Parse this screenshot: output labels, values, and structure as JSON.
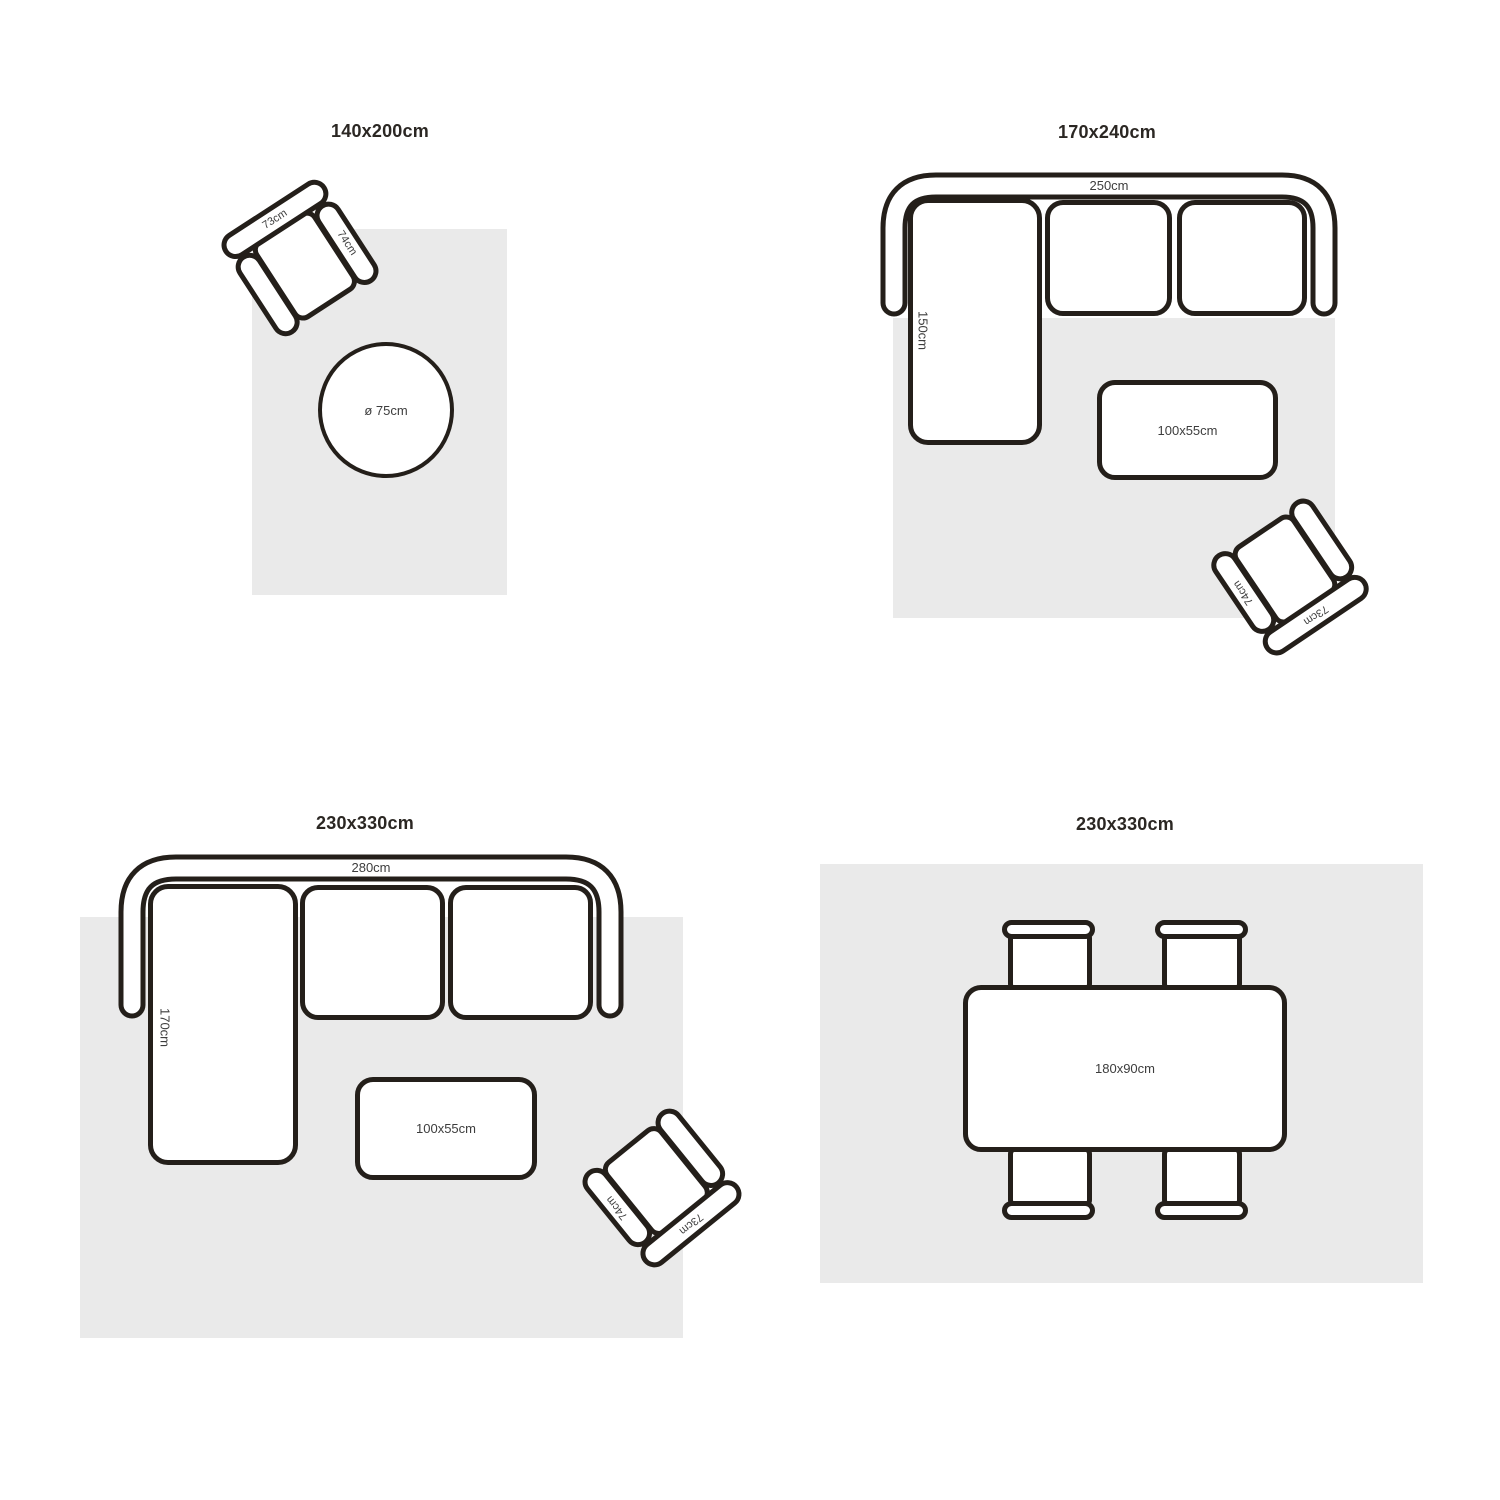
{
  "colors": {
    "background": "#ffffff",
    "rug": "#eaeaea",
    "outline": "#241f1a",
    "title_text": "#2b2723",
    "label_text": "#3d3d3d"
  },
  "scenes": [
    {
      "title": "140x200cm",
      "armchair": {
        "back_label": "73cm",
        "arm_label": "74cm"
      },
      "round_table": {
        "label": "ø 75cm"
      }
    },
    {
      "title": "170x240cm",
      "sofa": {
        "width_label": "250cm",
        "depth_label": "150cm"
      },
      "coffee_table": {
        "label": "100x55cm"
      },
      "armchair": {
        "back_label": "73cm",
        "arm_label": "74cm"
      }
    },
    {
      "title": "230x330cm",
      "sofa": {
        "width_label": "280cm",
        "depth_label": "170cm"
      },
      "coffee_table": {
        "label": "100x55cm"
      },
      "armchair": {
        "back_label": "73cm",
        "arm_label": "74cm"
      }
    },
    {
      "title": "230x330cm",
      "dining_table": {
        "label": "180x90cm"
      }
    }
  ]
}
